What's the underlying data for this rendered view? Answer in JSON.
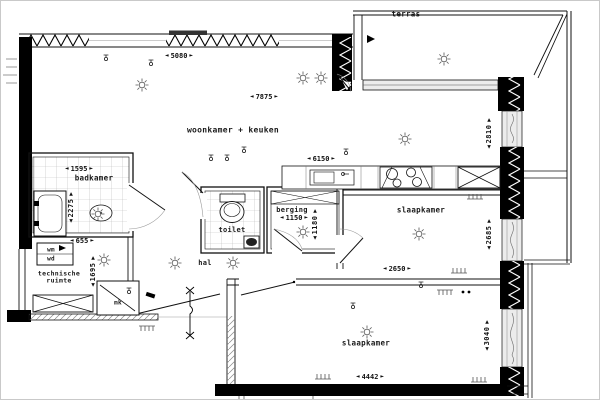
{
  "icons": {
    "arrow_left": "◄",
    "arrow_right": "►",
    "arrow_up": "▲",
    "arrow_down": "▼"
  },
  "rooms": {
    "terras": {
      "label": "terras"
    },
    "woonkamer_keuken": {
      "label": "woonkamer + keuken",
      "dim_window": "5080",
      "dim_width": "7875",
      "dim_kitchen": "6150",
      "dim_depth": "2810"
    },
    "badkamer": {
      "label": "badkamer",
      "dim_width": "1595",
      "dim_depth": "2275"
    },
    "technische_ruimte": {
      "label_line1": "technische",
      "label_line2": "ruimte",
      "dim_width": "655",
      "dim_depth": "1695",
      "appliance_top": "wm",
      "appliance_bottom": "wd"
    },
    "toilet": {
      "label": "toilet"
    },
    "berging": {
      "label": "berging",
      "dim_width": "1150",
      "dim_depth": "1180"
    },
    "hal": {
      "label": "hal"
    },
    "meterkast": {
      "label": "mk"
    },
    "slaapkamer_1": {
      "label": "slaapkamer",
      "dim_depth": "2685"
    },
    "slaapkamer_2": {
      "label": "slaapkamer",
      "dim_width_top": "2650",
      "dim_width_bottom": "4442",
      "dim_depth": "3040"
    }
  },
  "colors": {
    "wall": "#000000",
    "line": "#1a1a1a",
    "window_fill": "#ececec",
    "tile_line": "#b9b9b9",
    "background": "#ffffff"
  }
}
